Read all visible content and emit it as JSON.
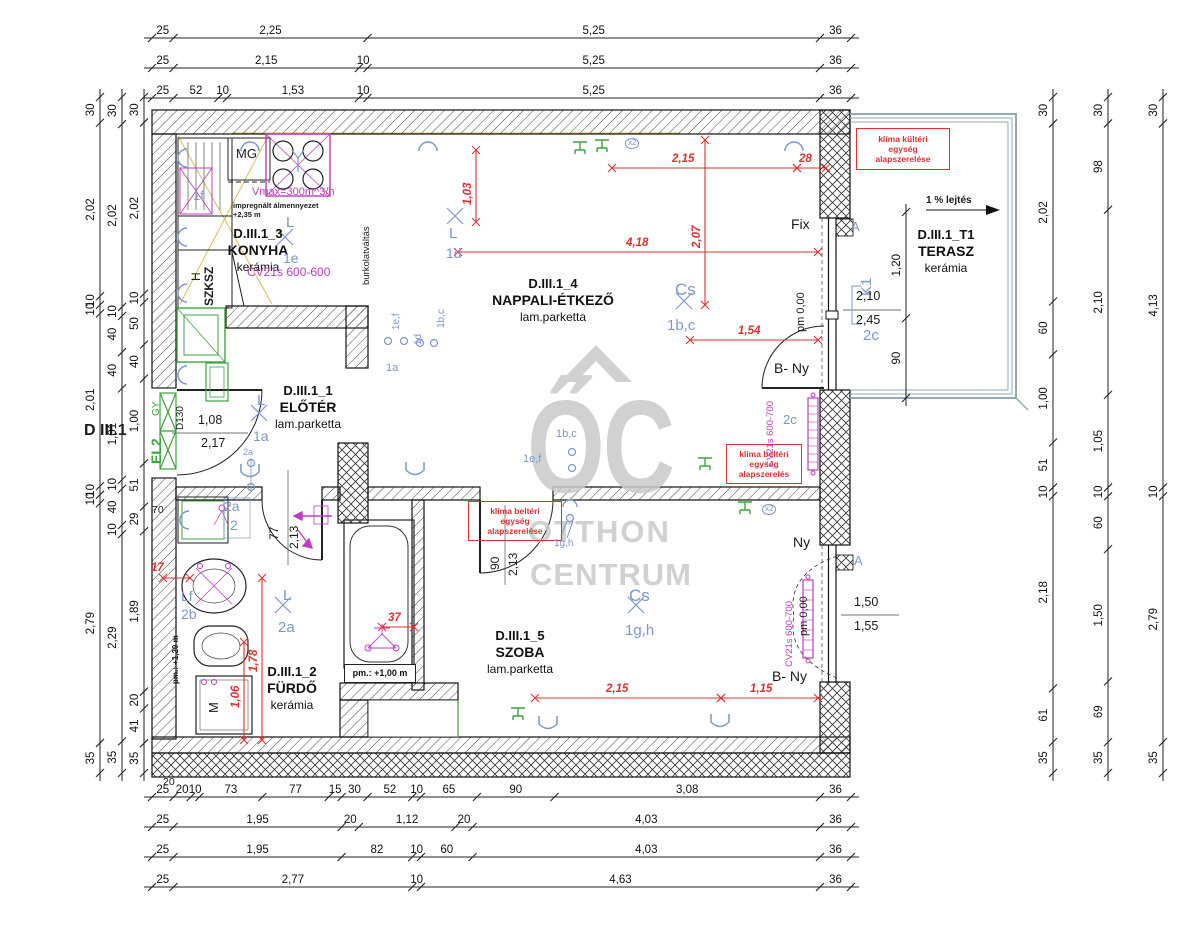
{
  "colors": {
    "k": "#1b1b1b",
    "blue": "#7d96cf",
    "red": "#e03030",
    "mag": "#c03cc0",
    "green": "#3da53d",
    "gray": "#c9c9c9",
    "rail": "#93a9b6",
    "yellow": "#d8be55"
  },
  "watermark": {
    "logo": "ŐC",
    "line1": "OTTHON",
    "line2": "CENTRUM"
  },
  "rooms": [
    {
      "id": "D.III.1_1",
      "name": "ELŐTÉR",
      "floor": "lam.parketta",
      "cx": 308,
      "y": 383
    },
    {
      "id": "D.III.1_2",
      "name": "FÜRDŐ",
      "floor": "kerámia",
      "cx": 292,
      "y": 664
    },
    {
      "id": "D.III.1_3",
      "name": "KONYHA",
      "floor": "kerámia",
      "cx": 258,
      "y": 226
    },
    {
      "id": "D.III.1_4",
      "name": "NAPPALI-ÉTKEZŐ",
      "floor": "lam.parketta",
      "cx": 553,
      "y": 276
    },
    {
      "id": "D.III.1_5",
      "name": "SZOBA",
      "floor": "lam.parketta",
      "cx": 520,
      "y": 628
    },
    {
      "id": "D.III.1_T1",
      "name": "TERASZ",
      "floor": "kerámia",
      "cx": 946,
      "y": 227
    }
  ],
  "boxes": [
    {
      "lines": [
        "klíma kültéri",
        "egység",
        "alapszerelése"
      ]
    },
    {
      "lines": [
        "klíma beltéri",
        "egység",
        "alapszerelés"
      ]
    },
    {
      "lines": [
        "klíma beltéri",
        "egység",
        "alapszerelése"
      ]
    },
    {
      "lines": [
        "pm.: +1,00 m"
      ]
    }
  ],
  "dim_chains": [
    {
      "o": "h",
      "x": 152,
      "y": 38,
      "span": 699,
      "seg": [
        "25",
        "2,25",
        "5,25",
        "36"
      ]
    },
    {
      "o": "h",
      "x": 152,
      "y": 68,
      "span": 699,
      "seg": [
        "25",
        "2,15",
        "10",
        "5,25",
        "36"
      ]
    },
    {
      "o": "h",
      "x": 152,
      "y": 98,
      "span": 699,
      "seg": [
        "25",
        "52",
        "10",
        "1,53",
        "10",
        "5,25",
        "36"
      ]
    },
    {
      "o": "h",
      "x": 152,
      "y": 797,
      "span": 699,
      "seg": [
        "25",
        "20",
        "10",
        "73",
        "77",
        "15",
        "30",
        "52",
        "10",
        "65",
        "90",
        "3,08",
        "36"
      ]
    },
    {
      "o": "h",
      "x": 152,
      "y": 827,
      "span": 699,
      "seg": [
        "25",
        "1,95",
        "20",
        "1,12",
        "20",
        "4,03",
        "36"
      ]
    },
    {
      "o": "h",
      "x": 152,
      "y": 857,
      "span": 699,
      "seg": [
        "25",
        "1,95",
        "82",
        "10",
        "60",
        "4,03",
        "36"
      ]
    },
    {
      "o": "h",
      "x": 152,
      "y": 887,
      "span": 699,
      "seg": [
        "25",
        "2,77",
        "10",
        "4,63",
        "36"
      ]
    },
    {
      "o": "v",
      "x": 100,
      "y": 97,
      "span": 676,
      "seg": [
        "30",
        "2,02",
        "10",
        "10",
        "2,01",
        "10",
        "10",
        "2,79",
        "35"
      ]
    },
    {
      "o": "v",
      "x": 122,
      "y": 97,
      "span": 676,
      "seg": [
        "30",
        "2,02",
        "10",
        "40",
        "40",
        "1,01",
        "10",
        "40",
        "10",
        "2,29",
        "35"
      ]
    },
    {
      "o": "v",
      "x": 144,
      "y": 97,
      "span": 676,
      "seg": [
        "30",
        "2,02",
        "10",
        "50",
        "40",
        "1,00",
        "51",
        "29",
        "1,89",
        "20",
        "41",
        "35"
      ]
    },
    {
      "o": "v",
      "x": 1053,
      "y": 97,
      "span": 676,
      "seg": [
        "30",
        "2,02",
        "60",
        "1,00",
        "51",
        "10",
        "2,18",
        "61",
        "35"
      ]
    },
    {
      "o": "v",
      "x": 1108,
      "y": 97,
      "span": 676,
      "seg": [
        "30",
        "98",
        "2,10",
        "1,05",
        "10",
        "60",
        "1,50",
        "69",
        "35"
      ]
    },
    {
      "o": "v",
      "x": 1163,
      "y": 97,
      "span": 676,
      "seg": [
        "30",
        "4,13",
        "10",
        "2,79",
        "35"
      ]
    },
    {
      "o": "v",
      "x": 906,
      "y": 212,
      "span": 186,
      "seg": [
        "1,20",
        "90"
      ]
    }
  ],
  "inner_dims": [
    {
      "o": "v",
      "x": 476,
      "a": 150,
      "b": 222,
      "t": "1,03",
      "lx": 463,
      "ly": 205,
      "r": 1
    },
    {
      "o": "h",
      "y": 168,
      "a": 612,
      "b": 797,
      "t": "2,15",
      "lx": 672,
      "ly": 154
    },
    {
      "o": "h",
      "y": 168,
      "a": 797,
      "b": 826,
      "t": "28",
      "lx": 799,
      "ly": 154
    },
    {
      "o": "v",
      "x": 705,
      "a": 140,
      "b": 305,
      "t": "2,07",
      "lx": 692,
      "ly": 248,
      "r": 1
    },
    {
      "o": "h",
      "y": 252,
      "a": 458,
      "b": 818,
      "t": "4,18",
      "lx": 626,
      "ly": 238
    },
    {
      "o": "h",
      "y": 340,
      "a": 690,
      "b": 818,
      "t": "1,54",
      "lx": 738,
      "ly": 326
    },
    {
      "o": "v",
      "x": 262,
      "a": 578,
      "b": 740,
      "t": "1,78",
      "lx": 249,
      "ly": 672,
      "r": 1
    },
    {
      "o": "v",
      "x": 244,
      "a": 642,
      "b": 740,
      "t": "1,06",
      "lx": 231,
      "ly": 708,
      "r": 1
    },
    {
      "o": "h",
      "y": 627,
      "a": 382,
      "b": 414,
      "t": "37",
      "lx": 388,
      "ly": 613
    },
    {
      "o": "h",
      "y": 698,
      "a": 535,
      "b": 721,
      "t": "2,15",
      "lx": 606,
      "ly": 684
    },
    {
      "o": "h",
      "y": 698,
      "a": 721,
      "b": 818,
      "t": "1,15",
      "lx": 750,
      "ly": 684
    },
    {
      "o": "h",
      "y": 578,
      "a": 163,
      "b": 190,
      "t": "17",
      "lx": 151,
      "ly": 563
    }
  ],
  "labels": [
    {
      "n": "microwave-label",
      "t": "MG",
      "x": 236,
      "y": 147,
      "s": 13
    },
    {
      "n": "ceiling-note-1",
      "t": "impregnált álmennyezet",
      "x": 233,
      "y": 202,
      "s": 7.5,
      "b": 1
    },
    {
      "n": "ceiling-note-2",
      "t": "+2,35 m",
      "x": 233,
      "y": 211,
      "s": 7.5,
      "b": 1
    },
    {
      "n": "fix-window-label",
      "t": "Fix",
      "x": 791,
      "y": 217,
      "s": 14
    },
    {
      "n": "window-label-ny",
      "t": "Ny",
      "x": 793,
      "y": 535,
      "s": 14
    },
    {
      "n": "door-label-bny-1",
      "t": "B- Ny",
      "x": 774,
      "y": 361,
      "s": 14
    },
    {
      "n": "door-label-bny-2",
      "t": "B- Ny",
      "x": 772,
      "y": 669,
      "s": 14
    },
    {
      "n": "apartment-id",
      "t": "D III.1",
      "x": 84,
      "y": 423,
      "s": 16,
      "b": 1
    },
    {
      "n": "dim-20",
      "t": "20",
      "x": 163,
      "y": 777,
      "s": 10.5
    },
    {
      "n": "dim-70",
      "t": "70",
      "x": 152,
      "y": 505,
      "s": 10.5
    },
    {
      "n": "slope-label",
      "t": "1 % lejtés",
      "x": 926,
      "y": 196,
      "s": 10,
      "b": 1
    },
    {
      "n": "bath-door-width",
      "t": "77",
      "x": 268,
      "y": 540,
      "s": 12,
      "r": 1
    },
    {
      "n": "bath-door-height",
      "t": "2,13",
      "x": 288,
      "y": 549,
      "s": 12,
      "r": 1
    },
    {
      "n": "szoba-door-width",
      "t": "90",
      "x": 489,
      "y": 570,
      "s": 12,
      "r": 1
    },
    {
      "n": "szoba-door-height",
      "t": "2,13",
      "x": 507,
      "y": 576,
      "s": 12,
      "r": 1
    },
    {
      "n": "closet-h",
      "t": "H",
      "x": 190,
      "y": 281,
      "s": 12,
      "r": 1
    },
    {
      "n": "closet-szksz",
      "t": "SZKSZ",
      "x": 203,
      "y": 306,
      "s": 12,
      "b": 1,
      "r": 1
    },
    {
      "n": "washer-label",
      "t": "M",
      "x": 207,
      "y": 713,
      "s": 13,
      "r": 1
    },
    {
      "n": "entry-door-type",
      "t": "D130",
      "x": 176,
      "y": 430,
      "s": 10,
      "r": 1
    },
    {
      "n": "floor-change-note",
      "t": "burkolatváltás",
      "x": 362,
      "y": 285,
      "s": 9.5,
      "r": 1
    },
    {
      "n": "pm-000-fix",
      "t": "pm 0,00",
      "x": 796,
      "y": 332,
      "s": 11,
      "r": 1
    },
    {
      "n": "pm-000-szoba",
      "t": "pm 0,00",
      "x": 799,
      "y": 636,
      "s": 11,
      "r": 1
    },
    {
      "n": "pm-120",
      "t": "pm.: +1,20 m",
      "x": 172,
      "y": 684,
      "s": 8,
      "b": 1,
      "r": 1
    },
    {
      "n": "lamp-l-kitchen",
      "t": "L",
      "x": 286,
      "y": 215,
      "s": 15,
      "c": "blue"
    },
    {
      "n": "lamp-1e",
      "t": "1e",
      "x": 283,
      "y": 251,
      "s": 14,
      "c": "blue"
    },
    {
      "n": "lamp-1f",
      "t": "1f",
      "x": 193,
      "y": 189,
      "s": 13,
      "c": "blue"
    },
    {
      "n": "radiator-kitchen",
      "t": "CV21s 600-600",
      "x": 247,
      "y": 266,
      "s": 12,
      "c": "mag"
    },
    {
      "n": "lamp-l-nappali",
      "t": "L",
      "x": 449,
      "y": 226,
      "s": 15,
      "c": "blue"
    },
    {
      "n": "lamp-1d",
      "t": "1d",
      "x": 446,
      "y": 246,
      "s": 14,
      "c": "blue"
    },
    {
      "n": "lamp-cs-nappali",
      "t": "Cs",
      "x": 675,
      "y": 281,
      "s": 17,
      "c": "blue"
    },
    {
      "n": "lamp-1bc",
      "t": "1b,c",
      "x": 667,
      "y": 318,
      "s": 15,
      "c": "blue"
    },
    {
      "n": "lamp-l-eloter",
      "t": "L",
      "x": 257,
      "y": 393,
      "s": 15,
      "c": "blue"
    },
    {
      "n": "lamp-1a",
      "t": "1a",
      "x": 253,
      "y": 429,
      "s": 14,
      "c": "blue"
    },
    {
      "n": "lamp-l-furdo",
      "t": "L",
      "x": 283,
      "y": 588,
      "s": 15,
      "c": "blue"
    },
    {
      "n": "lamp-2a",
      "t": "2a",
      "x": 278,
      "y": 620,
      "s": 15,
      "c": "blue"
    },
    {
      "n": "lamp-lf",
      "t": "Lf",
      "x": 181,
      "y": 589,
      "s": 14,
      "c": "blue"
    },
    {
      "n": "lamp-2b",
      "t": "2b",
      "x": 181,
      "y": 607,
      "s": 14,
      "c": "blue"
    },
    {
      "n": "lamp-cs-szoba",
      "t": "Cs",
      "x": 629,
      "y": 587,
      "s": 17,
      "c": "blue"
    },
    {
      "n": "lamp-1gh",
      "t": "1g,h",
      "x": 625,
      "y": 623,
      "s": 15,
      "c": "blue"
    },
    {
      "n": "pendant-1gh",
      "t": "1g,h",
      "x": 554,
      "y": 539,
      "s": 10,
      "c": "blue"
    },
    {
      "n": "switch-1bc-mid",
      "t": "1b,c",
      "x": 556,
      "y": 429,
      "s": 11,
      "c": "blue"
    },
    {
      "n": "switch-1ef-mid",
      "t": "1e,f",
      "x": 523,
      "y": 454,
      "s": 11,
      "c": "blue"
    },
    {
      "n": "switch-1ef",
      "t": "1e,f",
      "x": 392,
      "y": 330,
      "s": 10,
      "c": "blue",
      "r": 1
    },
    {
      "n": "switch-1d",
      "t": "1d",
      "x": 414,
      "y": 345,
      "s": 10,
      "c": "blue",
      "r": 1
    },
    {
      "n": "switch-1bc",
      "t": "1b,c",
      "x": 437,
      "y": 328,
      "s": 10,
      "c": "blue",
      "r": 1
    },
    {
      "n": "switch-1a",
      "t": "1a",
      "x": 386,
      "y": 363,
      "s": 11,
      "c": "blue"
    },
    {
      "n": "fixture-2a",
      "t": "2a",
      "x": 224,
      "y": 499,
      "s": 14,
      "c": "blue"
    },
    {
      "n": "fixture-2",
      "t": "2",
      "x": 230,
      "y": 518,
      "s": 14,
      "c": "blue"
    },
    {
      "n": "fixture-2a-small",
      "t": "2a",
      "x": 243,
      "y": 448,
      "s": 9,
      "c": "blue"
    },
    {
      "n": "window-k1",
      "t": "K1",
      "x": 859,
      "y": 296,
      "s": 15,
      "c": "blue",
      "r": 1
    },
    {
      "n": "window-2c",
      "t": "2c",
      "x": 863,
      "y": 328,
      "s": 15,
      "c": "blue"
    },
    {
      "n": "radiator-2c",
      "t": "2c",
      "x": 783,
      "y": 413,
      "s": 13,
      "c": "blue"
    },
    {
      "n": "detail-a-1",
      "t": "A",
      "x": 851,
      "y": 220,
      "s": 13,
      "c": "blue"
    },
    {
      "n": "detail-a-2",
      "t": "A",
      "x": 854,
      "y": 554,
      "s": 13,
      "c": "blue"
    },
    {
      "n": "count-x2-1",
      "t": "x2",
      "x": 625,
      "y": 138,
      "s": 8,
      "c": "blue",
      "circ": 1
    },
    {
      "n": "count-x2-2",
      "t": "x2",
      "x": 762,
      "y": 504,
      "s": 8,
      "c": "blue",
      "circ": 1
    },
    {
      "n": "vent-note",
      "t": "Vmax=300m^3/h",
      "x": 252,
      "y": 187,
      "s": 11,
      "c": "mag"
    },
    {
      "n": "radiator-nappali",
      "t": "CV21s 600-700",
      "x": 766,
      "y": 467,
      "s": 9.5,
      "c": "mag",
      "r": 1
    },
    {
      "n": "radiator-szoba",
      "t": "CV21s 600-700",
      "x": 785,
      "y": 667,
      "s": 9.5,
      "c": "mag",
      "r": 1
    },
    {
      "n": "entry-panel-el2",
      "t": "EL2",
      "x": 149,
      "y": 464,
      "s": 14,
      "c": "green",
      "b": 1,
      "r": 1
    },
    {
      "n": "entry-gy",
      "t": "GY",
      "x": 152,
      "y": 416,
      "s": 10,
      "c": "green",
      "r": 1
    },
    {
      "n": "entry-door-w",
      "t": "1,08",
      "x": 198,
      "y": 414,
      "s": 12.5
    },
    {
      "n": "entry-door-h",
      "t": "2,17",
      "x": 201,
      "y": 437,
      "s": 12.5
    },
    {
      "n": "k1-size-top",
      "t": "2,10",
      "x": 856,
      "y": 290,
      "s": 12.5
    },
    {
      "n": "k1-size-bot",
      "t": "2,45",
      "x": 856,
      "y": 314,
      "s": 12.5
    },
    {
      "n": "szw-size-top",
      "t": "1,50",
      "x": 854,
      "y": 596,
      "s": 12.5
    },
    {
      "n": "szw-size-bot",
      "t": "1,55",
      "x": 854,
      "y": 620,
      "s": 12.5
    }
  ],
  "symbols": [
    {
      "t": "arc",
      "x": 428,
      "y": 148
    },
    {
      "t": "arc",
      "x": 794,
      "y": 148
    },
    {
      "t": "arc",
      "x": 250,
      "y": 148
    },
    {
      "t": "arcR",
      "x": 184,
      "y": 158
    },
    {
      "t": "arcR",
      "x": 184,
      "y": 237
    },
    {
      "t": "arcR",
      "x": 184,
      "y": 293
    },
    {
      "t": "arcR",
      "x": 184,
      "y": 375
    },
    {
      "t": "arcR",
      "x": 186,
      "y": 520
    },
    {
      "t": "u",
      "x": 250,
      "y": 470
    },
    {
      "t": "u",
      "x": 415,
      "y": 468
    },
    {
      "t": "u",
      "x": 548,
      "y": 722
    },
    {
      "t": "u",
      "x": 720,
      "y": 720
    },
    {
      "t": "sock",
      "x": 580,
      "y": 152
    },
    {
      "t": "sock",
      "x": 602,
      "y": 150
    },
    {
      "t": "sock",
      "x": 745,
      "y": 512
    },
    {
      "t": "sock",
      "x": 518,
      "y": 718
    },
    {
      "t": "sock",
      "x": 705,
      "y": 468
    },
    {
      "t": "X",
      "x": 285,
      "y": 237
    },
    {
      "t": "X",
      "x": 455,
      "y": 216
    },
    {
      "t": "X",
      "x": 684,
      "y": 301
    },
    {
      "t": "X",
      "x": 259,
      "y": 413
    },
    {
      "t": "X",
      "x": 283,
      "y": 605
    },
    {
      "t": "X",
      "x": 636,
      "y": 605
    },
    {
      "t": "c",
      "x": 388,
      "y": 341
    },
    {
      "t": "c",
      "x": 404,
      "y": 341
    },
    {
      "t": "c",
      "x": 420,
      "y": 343
    },
    {
      "t": "c",
      "x": 434,
      "y": 343
    },
    {
      "t": "c",
      "x": 572,
      "y": 452
    },
    {
      "t": "c",
      "x": 572,
      "y": 468
    },
    {
      "t": "c",
      "x": 251,
      "y": 463
    },
    {
      "t": "c",
      "x": 251,
      "y": 487
    },
    {
      "t": "pend",
      "x": 570,
      "y": 512
    }
  ]
}
